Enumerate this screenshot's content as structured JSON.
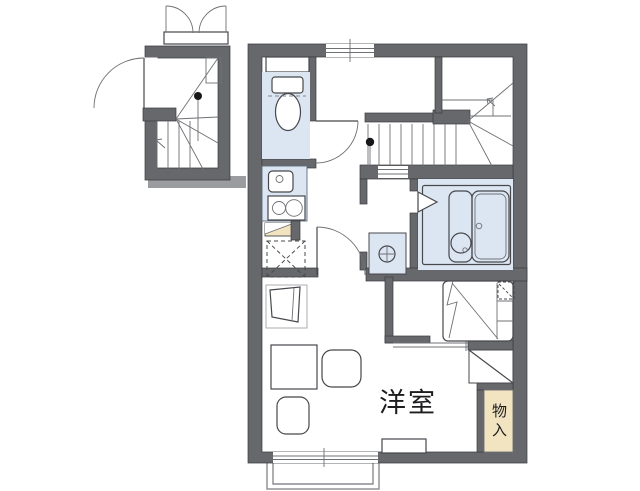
{
  "plan": {
    "labels": {
      "western_room": "洋室",
      "storage": "物入"
    },
    "fixtures": [
      "toilet",
      "toilet-cabinet",
      "kitchen-sink",
      "gas-stove-2-burner",
      "counter-shelf",
      "refrigerator-space",
      "washing-machine-area",
      "bathtub",
      "washbasin",
      "bath-folding-door",
      "bed",
      "desk",
      "chair",
      "chair",
      "tv-stand",
      "main-staircase",
      "entrance-staircase",
      "entrance-door",
      "shoe-cabinet-double-doors",
      "balcony",
      "storage-closet",
      "windows"
    ],
    "colors": {
      "wall": "#66686c",
      "wall_edge": "#3a3b3f",
      "line": "#47484c",
      "thin": "#6f7074",
      "fixture_blue": "#dce6f2",
      "blue_edge": "#5d6b7a",
      "beige": "#f2e4c1",
      "light_bar": "#9b9c9f",
      "label_text": "#1d1d1f",
      "background": "#ffffff"
    }
  }
}
